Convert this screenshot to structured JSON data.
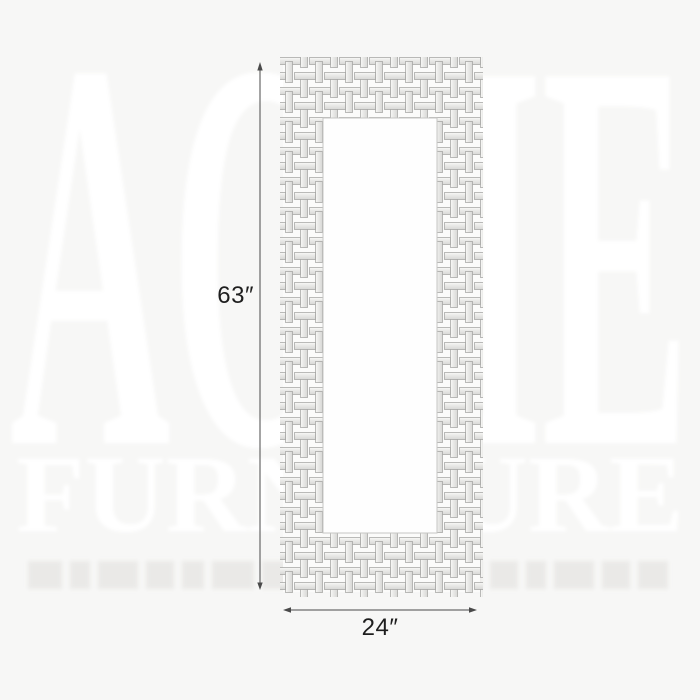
{
  "page": {
    "background_color": "#f7f7f6"
  },
  "watermark": {
    "brand": "ACME",
    "brand_sub": "FURNITURE",
    "color": "#ffffff"
  },
  "diagram": {
    "subject": "tall rectangular wall mirror with mosaic basketweave tile frame",
    "height_label": "63″",
    "width_label": "24″",
    "dimension_line_color": "#4a4a4a",
    "dimension_text_color": "#1e1e1e",
    "frame_tile_color": "#e9e9e7",
    "frame_tile_highlight_color": "#f9f9f7",
    "frame_tile_edge_color": "#9f9f9d",
    "mirror_color": "#fefefe"
  }
}
